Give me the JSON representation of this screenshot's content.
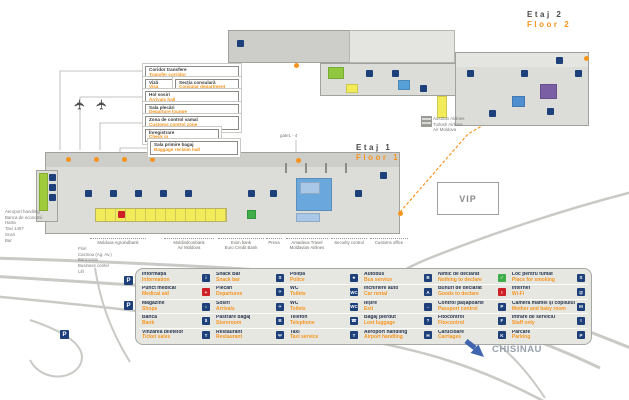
{
  "floors": {
    "floor2": {
      "ro": "Etaj 2",
      "en": "Floor 2"
    },
    "floor1": {
      "ro": "Etaj 1",
      "en": "Floor 1"
    }
  },
  "gate_label": "gate1 - 4",
  "vip_label": "VIP",
  "city_label": "CHISINAU",
  "airlines_note": {
    "line1": "Austrian Airlines",
    "line2": "Turkish Airlines",
    "line3": "Air Moldova"
  },
  "callouts": {
    "transfer": {
      "ro": "Coridor transfere",
      "en": "Transfer corridor"
    },
    "visa": {
      "ro": "Viză",
      "en": "Visa"
    },
    "consular": {
      "ro": "Secția consulară",
      "en": "Consular department"
    },
    "arrivals_hall": {
      "ro": "Hol sosiri",
      "en": "Arrivals hall"
    },
    "departure_lounge": {
      "ro": "Sala plecări",
      "en": "Departure lounge"
    },
    "customs_zone": {
      "ro": "Zona de control vamal",
      "en": "Customs control zone"
    },
    "checkin": {
      "ro": "Înregistrare",
      "en": "Check in"
    },
    "baggage": {
      "ro": "Sala primire bagaj",
      "en": "Baggage reclaim hall"
    }
  },
  "left_notes": [
    "Aeroport handling",
    "Banca de economii",
    "Harta",
    "Taxi 1407",
    "Scari",
    "Bar"
  ],
  "shop_notes": [
    "Flori",
    "Cazinou (Ag. Av.)",
    "Bancomat",
    "Business center",
    "Lift"
  ],
  "bottom_notes": [
    {
      "l1": "Moldova Agroindbank",
      "l2": ""
    },
    {
      "l1": "Moldindconbank",
      "l2": "Air Moldova"
    },
    {
      "l1": "Exim bank",
      "l2": "Euro Credit Bank"
    },
    {
      "l1": "Presa",
      "l2": ""
    },
    {
      "l1": "Amadeus Travel",
      "l2": "Moldavian Airlines"
    },
    {
      "l1": "Security control",
      "l2": ""
    },
    {
      "l1": "Customs office",
      "l2": ""
    }
  ],
  "map_icons": {
    "parking_glyph": "P"
  },
  "legend": {
    "columns": [
      {
        "rows": [
          {
            "ro": "Informația",
            "en": "Information",
            "glyph": "i"
          },
          {
            "ro": "Punct medical",
            "en": "Medical aid",
            "glyph": "+"
          },
          {
            "ro": "Magazine",
            "en": "Shops",
            "glyph": "⌂"
          },
          {
            "ro": "Banca",
            "en": "Bank",
            "glyph": "$"
          },
          {
            "ro": "Vinzarea biletelor",
            "en": "Ticket sales",
            "glyph": "T"
          }
        ]
      },
      {
        "rows": [
          {
            "ro": "Snack Bar",
            "en": "Snack bar",
            "glyph": "S"
          },
          {
            "ro": "Plecări",
            "en": "Departures",
            "glyph": "✈"
          },
          {
            "ro": "Sosiri",
            "en": "Arrivals",
            "glyph": "✈"
          },
          {
            "ro": "Pastrare bagaj",
            "en": "Storeroom",
            "glyph": "B"
          },
          {
            "ro": "Restaurant",
            "en": "Restaurant",
            "glyph": "Ψ"
          }
        ]
      },
      {
        "rows": [
          {
            "ro": "Poliția",
            "en": "Police",
            "glyph": "★"
          },
          {
            "ro": "WC",
            "en": "Toilets",
            "glyph": "WC"
          },
          {
            "ro": "WC",
            "en": "Toilets",
            "glyph": "WC"
          },
          {
            "ro": "Telefon",
            "en": "Telephone",
            "glyph": "☎"
          },
          {
            "ro": "Taxi",
            "en": "Taxi service",
            "glyph": "T"
          }
        ]
      },
      {
        "rows": [
          {
            "ro": "Autobus",
            "en": "Bus service",
            "glyph": "B"
          },
          {
            "ro": "Închiriere auto",
            "en": "Car rental",
            "glyph": "A"
          },
          {
            "ro": "Ieșire",
            "en": "Exit",
            "glyph": "→"
          },
          {
            "ro": "Bagaj pierdut",
            "en": "Lost luggage",
            "glyph": "?"
          },
          {
            "ro": "Aeroport handling",
            "en": "Airport handling",
            "glyph": "H"
          }
        ]
      },
      {
        "rows": [
          {
            "ro": "Nimic de declarat",
            "en": "Nothing to declare",
            "glyph": "✓"
          },
          {
            "ro": "Bunuri de declarat",
            "en": "Goods to declare",
            "glyph": "!"
          },
          {
            "ro": "Control pașapoarte",
            "en": "Passport control",
            "glyph": "P"
          },
          {
            "ro": "Fitocontrol",
            "en": "Fitocontrol",
            "glyph": "F"
          },
          {
            "ro": "Cărucioare",
            "en": "Carriages",
            "glyph": "K"
          }
        ]
      },
      {
        "rows": [
          {
            "ro": "Loc pentru fumat",
            "en": "Place for smoking",
            "glyph": "S"
          },
          {
            "ro": "Internet",
            "en": "Wi-Fi",
            "glyph": "@"
          },
          {
            "ro": "Camera mamei și copilului",
            "en": "Mother and baby room",
            "glyph": "M"
          },
          {
            "ro": "Intrare de serviciu",
            "en": "Staff only",
            "glyph": "I"
          },
          {
            "ro": "Parcare",
            "en": "Parking",
            "glyph": "P"
          }
        ]
      }
    ]
  },
  "colors": {
    "accent_orange": "#F7941D",
    "navy_icon": "#1D3F7A",
    "red_icon": "#CE2127",
    "green_icon": "#3FAE49",
    "terminal_gray": "#DCDCD8",
    "road_gray": "#C9C9C5",
    "arrow_blue": "#4065AE",
    "desk_yellow": "#F2EC5A",
    "gate_blue": "#6AA7DC",
    "room_purple": "#7B5FA5"
  }
}
